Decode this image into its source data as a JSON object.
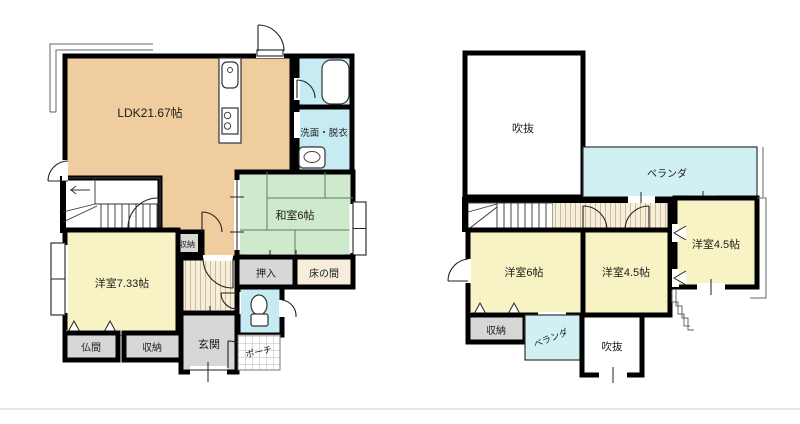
{
  "floor1": {
    "rooms": {
      "ldk": "LDK21.67帖",
      "washroom": "洗面・脱衣",
      "washitsu": "和室6帖",
      "oshiire": "押入",
      "tokonoma": "床の間",
      "closet_mid": "収納",
      "youshitsu": "洋室7.33帖",
      "butsuma": "仏間",
      "closet_bottom": "収納",
      "genkan": "玄関",
      "porch": "ポーチ"
    }
  },
  "floor2": {
    "rooms": {
      "void_top": "吹抜",
      "veranda_top": "ベランダ",
      "room6": "洋室6帖",
      "room45_mid": "洋室4.5帖",
      "room45_right": "洋室4.5帖",
      "closet": "収納",
      "veranda_bottom": "ベランダ",
      "void_bottom": "吹抜"
    }
  },
  "colors": {
    "ldk": "#f0cd9f",
    "tatami_room": "#cfe9cd",
    "western_room": "#f8f3c4",
    "water_area": "#c6ebf3",
    "veranda": "#d0f0f4",
    "service_gray": "#d7d7d7",
    "tokonoma": "#f6eeda",
    "hall_bg": "#f7efd9",
    "wall": "#000000"
  }
}
